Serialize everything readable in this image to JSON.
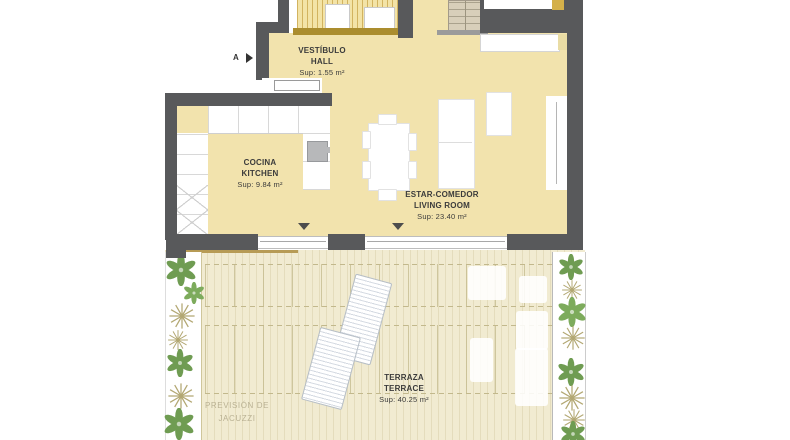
{
  "document": {
    "type": "architectural floor plan"
  },
  "section_marker": {
    "label": "A"
  },
  "rooms": {
    "vestibulo": {
      "name_primary": "VESTÍBULO",
      "name_secondary": "HALL",
      "area": "Sup: 1.55 m²"
    },
    "cocina": {
      "name_primary": "COCINA",
      "name_secondary": "KITCHEN",
      "area": "Sup: 9.84 m²"
    },
    "estar": {
      "name_primary": "ESTAR-COMEDOR",
      "name_secondary": "LIVING ROOM",
      "area": "Sup: 23.40 m²"
    },
    "terraza": {
      "name_primary": "TERRAZA",
      "name_secondary": "TERRACE",
      "area": "Sup: 40.25 m²"
    }
  },
  "annotations": {
    "jacuzzi": {
      "line1": "PREVISIÓN DE",
      "line2": "JACUZZI"
    }
  },
  "colors": {
    "wall": "#58595b",
    "floor_interior": "#f2e3ad",
    "floor_terrace": "#f1ebd1",
    "accent_gold": "#ab8d2e",
    "plant_green": "#6f9c52",
    "plant_tan": "#b3a873"
  }
}
